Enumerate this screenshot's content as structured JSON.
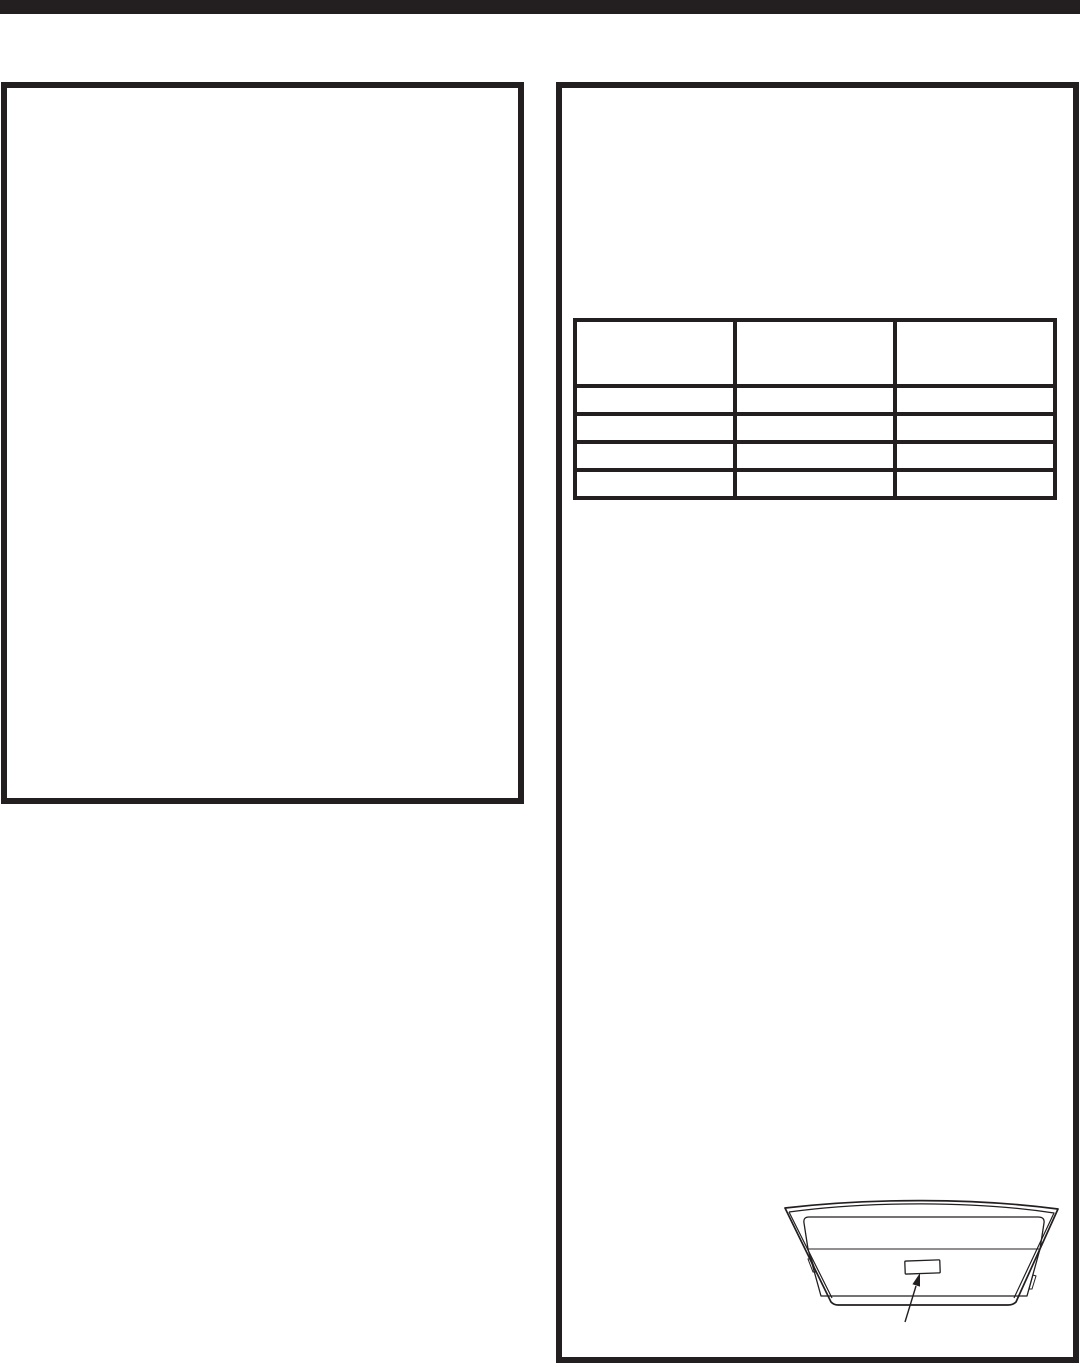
{
  "page": {
    "background_color": "#ffffff",
    "ink_color": "#231f20",
    "top_bar": {
      "color": "#231f20"
    }
  },
  "left_box": {
    "content": ""
  },
  "right_box": {
    "table": {
      "type": "table",
      "columns": [
        "",
        "",
        ""
      ],
      "rows": [
        [
          "",
          "",
          ""
        ],
        [
          "",
          "",
          ""
        ],
        [
          "",
          "",
          ""
        ],
        [
          "",
          "",
          ""
        ]
      ]
    },
    "illustration": {
      "name": "appliance-underside-with-rating-label-location",
      "label_text": ""
    }
  }
}
